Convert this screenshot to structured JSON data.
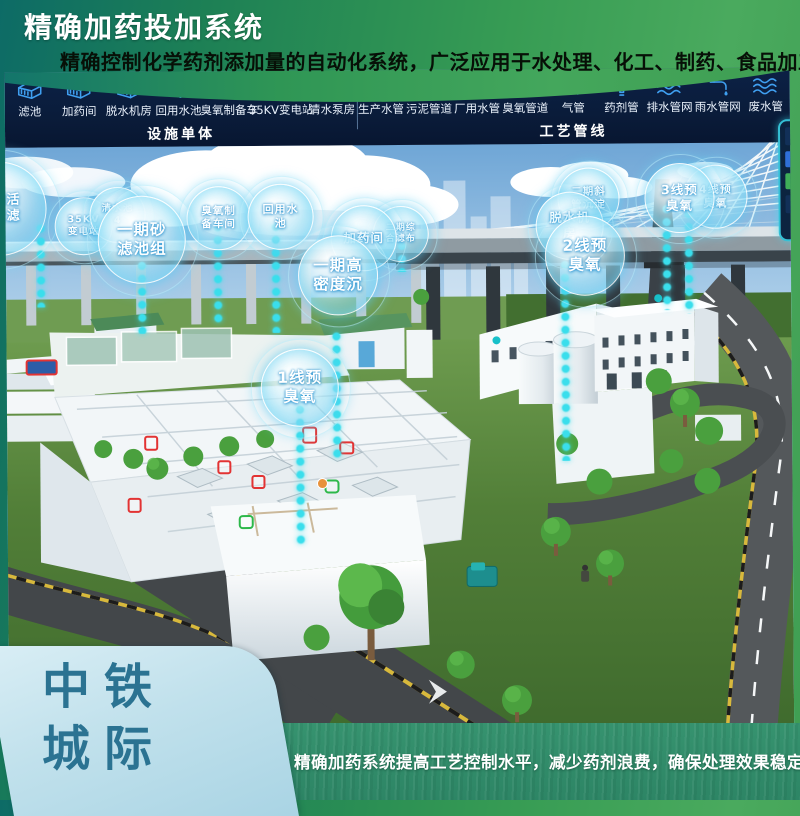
{
  "header": {
    "title": "精确加药投加系统",
    "subtitle": "精确控制化学药剂添加量的自动化系统，广泛应用于水处理、化工、制药、食品加工等行业"
  },
  "toolbar": {
    "facility_group": {
      "label": "设施单体",
      "items": [
        {
          "label": "滤池",
          "icon": "filter-pool-icon",
          "sym": "sym-building"
        },
        {
          "label": "加药间",
          "icon": "dosing-room-icon",
          "sym": "sym-building"
        },
        {
          "label": "脱水机房",
          "icon": "dewatering-room-icon",
          "sym": "sym-building"
        },
        {
          "label": "回用水池",
          "icon": "reuse-water-pool-icon",
          "sym": "sym-building"
        },
        {
          "label": "臭氧制备车",
          "icon": "ozone-preparation-icon",
          "sym": "sym-building"
        },
        {
          "label": "35KV变电站",
          "icon": "substation-35kv-icon",
          "sym": "sym-building"
        },
        {
          "label": "清水泵房",
          "icon": "clean-water-pump-room-icon",
          "sym": "sym-building"
        }
      ]
    },
    "pipeline_group": {
      "label": "工艺管线",
      "items": [
        {
          "label": "生产水管",
          "icon": "production-water-pipe-icon",
          "sym": "sym-pipe"
        },
        {
          "label": "污泥管道",
          "icon": "sludge-pipe-icon",
          "sym": "sym-pipe"
        },
        {
          "label": "厂用水管",
          "icon": "plant-water-pipe-icon",
          "sym": "sym-faucet"
        },
        {
          "label": "臭氧管道",
          "icon": "ozone-pipe-icon",
          "sym": "sym-pipe"
        },
        {
          "label": "气管",
          "icon": "gas-pipe-icon",
          "sym": "sym-pipe"
        },
        {
          "label": "药剂管",
          "icon": "chemical-pipe-icon",
          "sym": "sym-funnel"
        },
        {
          "label": "排水管网",
          "icon": "drainage-network-icon",
          "sym": "sym-wave"
        },
        {
          "label": "雨水管网",
          "icon": "rainwater-network-icon",
          "sym": "sym-faucet"
        },
        {
          "label": "废水管",
          "icon": "wastewater-pipe-icon",
          "sym": "sym-wave"
        }
      ]
    }
  },
  "scene": {
    "bubbles": [
      {
        "name": "bubble-phase1-activated-carbon-filter",
        "lines": [
          "一期活",
          "性炭滤"
        ],
        "x": -53,
        "y": 89,
        "d": 92,
        "fs": 13,
        "z": 3
      },
      {
        "name": "bubble-35kv-substation",
        "lines": [
          "35KV",
          "变电站"
        ],
        "x": 49,
        "y": 125,
        "d": 56,
        "fs": 9.5,
        "z": 3
      },
      {
        "name": "bubble-clean-water-pool-4",
        "lines": [
          "清水池",
          "4"
        ],
        "x": 84,
        "y": 115,
        "d": 54,
        "fs": 9.5,
        "z": 3
      },
      {
        "name": "bubble-phase1-sand-filter-group",
        "lines": [
          "一期砂",
          "滤池组"
        ],
        "x": 92,
        "y": 124,
        "d": 86,
        "fs": 15.5,
        "z": 4
      },
      {
        "name": "bubble-ozone-preparation-workshop",
        "lines": [
          "臭氧制",
          "备车间"
        ],
        "x": 181,
        "y": 115,
        "d": 62,
        "fs": 10.5,
        "z": 3
      },
      {
        "name": "bubble-reuse-water-pool",
        "lines": [
          "回用水",
          "池"
        ],
        "x": 242,
        "y": 113,
        "d": 64,
        "fs": 11,
        "z": 3
      },
      {
        "name": "bubble-dosing-room",
        "lines": [
          "加药间"
        ],
        "x": 325,
        "y": 135,
        "d": 64,
        "fs": 12.5,
        "z": 4
      },
      {
        "name": "bubble-phase2-filter-cloth",
        "lines": [
          "二期综",
          "合滤布"
        ],
        "x": 367,
        "y": 136,
        "d": 54,
        "fs": 9,
        "z": 3
      },
      {
        "name": "bubble-phase1-high-density-sedimentation",
        "lines": [
          "一期高",
          "密度沉"
        ],
        "x": 292,
        "y": 165,
        "d": 78,
        "fs": 15.5,
        "z": 5
      },
      {
        "name": "bubble-line1-pre-ozone",
        "lines": [
          "1线预",
          "臭氧"
        ],
        "x": 254,
        "y": 278,
        "d": 76,
        "fs": 15.5,
        "z": 5
      },
      {
        "name": "bubble-dewatering-room",
        "lines": [
          "脱水机",
          "房"
        ],
        "x": 530,
        "y": 123,
        "d": 66,
        "fs": 12.5,
        "z": 4
      },
      {
        "name": "bubble-line2-pre-ozone",
        "lines": [
          "2线预",
          "臭氧"
        ],
        "x": 539,
        "y": 147,
        "d": 78,
        "fs": 15.5,
        "z": 5
      },
      {
        "name": "bubble-phase2-inclined-tube-sedimentation",
        "lines": [
          "二期斜",
          "管沉淀"
        ],
        "x": 552,
        "y": 99,
        "d": 60,
        "fs": 10.5,
        "z": 3
      },
      {
        "name": "bubble-line3-pre-ozone",
        "lines": [
          "3线预",
          "臭氧"
        ],
        "x": 639,
        "y": 95,
        "d": 68,
        "fs": 12.5,
        "z": 4
      },
      {
        "name": "bubble-line4-pre-ozone",
        "lines": [
          "4线预",
          "臭氧"
        ],
        "x": 678,
        "y": 97,
        "d": 62,
        "fs": 11,
        "z": 3
      }
    ],
    "dotted_chains": [
      {
        "x": 35,
        "y1": 150,
        "y2": 235
      },
      {
        "x": 136,
        "y1": 175,
        "y2": 262
      },
      {
        "x": 212,
        "y1": 150,
        "y2": 255
      },
      {
        "x": 270,
        "y1": 150,
        "y2": 262
      },
      {
        "x": 396,
        "y1": 170,
        "y2": 202
      },
      {
        "x": 293,
        "y1": 320,
        "y2": 475
      },
      {
        "x": 330,
        "y1": 260,
        "y2": 390
      },
      {
        "x": 559,
        "y1": 190,
        "y2": 392
      },
      {
        "x": 661,
        "y1": 135,
        "y2": 242
      },
      {
        "x": 683,
        "y1": 140,
        "y2": 246
      }
    ]
  },
  "footer": {
    "brand_line1": "中铁",
    "brand_line2": "城际",
    "tagline": "精确加药系统提高工艺控制水平，减少药剂浪费，确保处理效果稳定"
  },
  "colors": {
    "header_green": "#379c54",
    "header_teal": "#0d6b66",
    "toolbar_navy": "#0a1c3a",
    "toolbar_icon_blue": "#3f9ff0",
    "bubble_cyan": "#3adeec",
    "card_light_blue": "#bfe0ec",
    "card_text_blue": "#2b7392",
    "banner_green": "#2f8b6c"
  }
}
